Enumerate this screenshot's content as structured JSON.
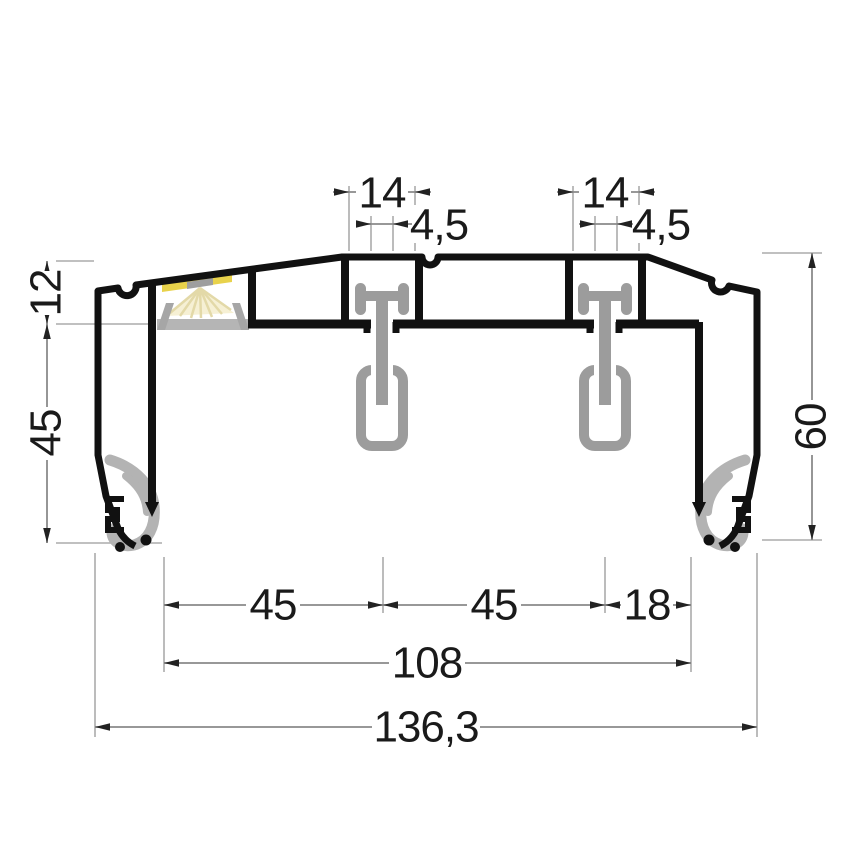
{
  "drawing": {
    "type": "technical-cross-section",
    "subject": "double curtain track profile with LED channel, gliders and gaskets"
  },
  "dimensions": {
    "top_left_channel_width": "14",
    "top_left_slot_width": "4,5",
    "top_right_channel_width": "14",
    "top_right_slot_width": "4,5",
    "left_channel_height": "12",
    "left_body_height": "45",
    "right_total_height": "60",
    "bottom_span_left": "45",
    "bottom_span_center": "45",
    "bottom_span_right": "18",
    "bottom_inner_width": "108",
    "bottom_total_width": "136,3"
  },
  "colors": {
    "outline": "#111111",
    "metal_gray": "#9c9c9c",
    "gasket_gray": "#b3b3b3",
    "diffuser_gray": "#b5b5b5",
    "led_glow": "#e8d24b",
    "led_rays": "#e3d9a8",
    "dim_line": "#8a8a8a",
    "ext_line": "#ababab",
    "text": "#1a1a1a",
    "background": "#ffffff"
  }
}
